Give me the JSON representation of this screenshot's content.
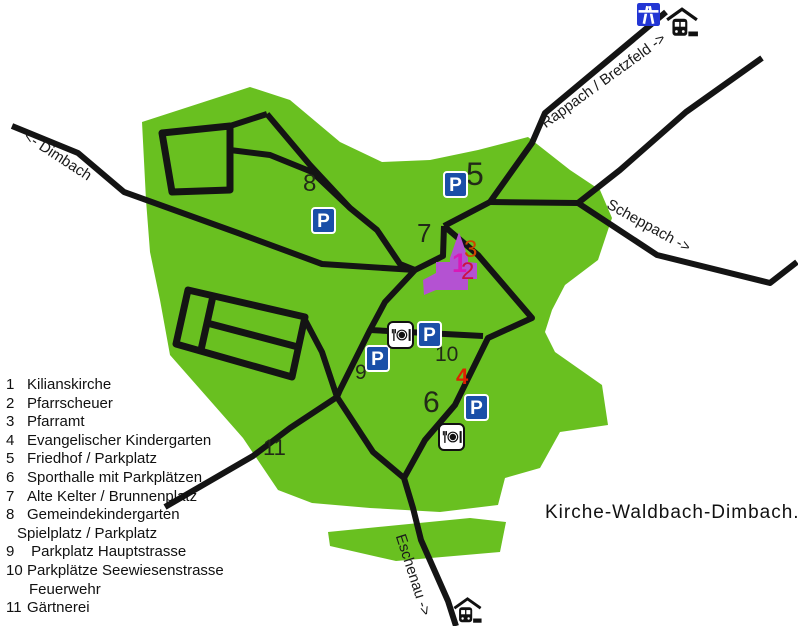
{
  "map": {
    "site_label": "Kirche-Waldbach-Dimbach.de",
    "parking_letter": "P",
    "road_labels": {
      "dimbach": "<- Dimbach",
      "rappach": "Rappach / Bretzfeld ->",
      "scheppach": "Scheppach ->",
      "eschenau": "Eschenau ->"
    },
    "markers": {
      "m1": "1",
      "m2": "2",
      "m3": "3",
      "m4": "4",
      "m5": "5",
      "m6": "6",
      "m7": "7",
      "m8": "8",
      "m9": "9",
      "m10": "10",
      "m11": "11"
    },
    "icons": {
      "parking": "parking-icon",
      "restaurant": "restaurant-icon",
      "train_station": "train-station-icon",
      "autobahn": "autobahn-icon",
      "church": "church-shape"
    },
    "colors": {
      "village_green": "#69c020",
      "road_black": "#141414",
      "parking_blue": "#1a4fa8",
      "autobahn_blue": "#2336d4",
      "church_orchid": "#b452d2",
      "marker_magenta": "#d819b8",
      "marker_crimson": "#cc1144",
      "marker_orange": "#cc4400",
      "marker_red": "#dd2200",
      "marker_dark": "#222a18"
    }
  },
  "legend": {
    "items": [
      {
        "num": "1",
        "text": "Kilianskirche",
        "indent": 0
      },
      {
        "num": "2",
        "text": "Pfarrscheuer",
        "indent": 0
      },
      {
        "num": "3",
        "text": "Pfarramt",
        "indent": 0
      },
      {
        "num": "4",
        "text": "Evangelischer Kindergarten",
        "indent": 0
      },
      {
        "num": "5",
        "text": "Friedhof / Parkplatz",
        "indent": 0
      },
      {
        "num": "6",
        "text": "Sporthalle mit Parkplätzen",
        "indent": 0
      },
      {
        "num": "7",
        "text": "Alte Kelter / Brunnenplatz",
        "indent": 0
      },
      {
        "num": "8",
        "text": "Gemeindekindergarten",
        "indent": 0
      },
      {
        "num": "",
        "text": "Spielplatz / Parkplatz",
        "indent": 1
      },
      {
        "num": "9",
        "text": " Parkplatz Hauptstrasse",
        "indent": 0
      },
      {
        "num": "10",
        "text": "Parkplätze Seewiesenstrasse",
        "indent": 0
      },
      {
        "num": "",
        "text": "Feuerwehr",
        "indent": 2
      },
      {
        "num": "11",
        "text": "Gärtnerei",
        "indent": 0
      }
    ]
  }
}
